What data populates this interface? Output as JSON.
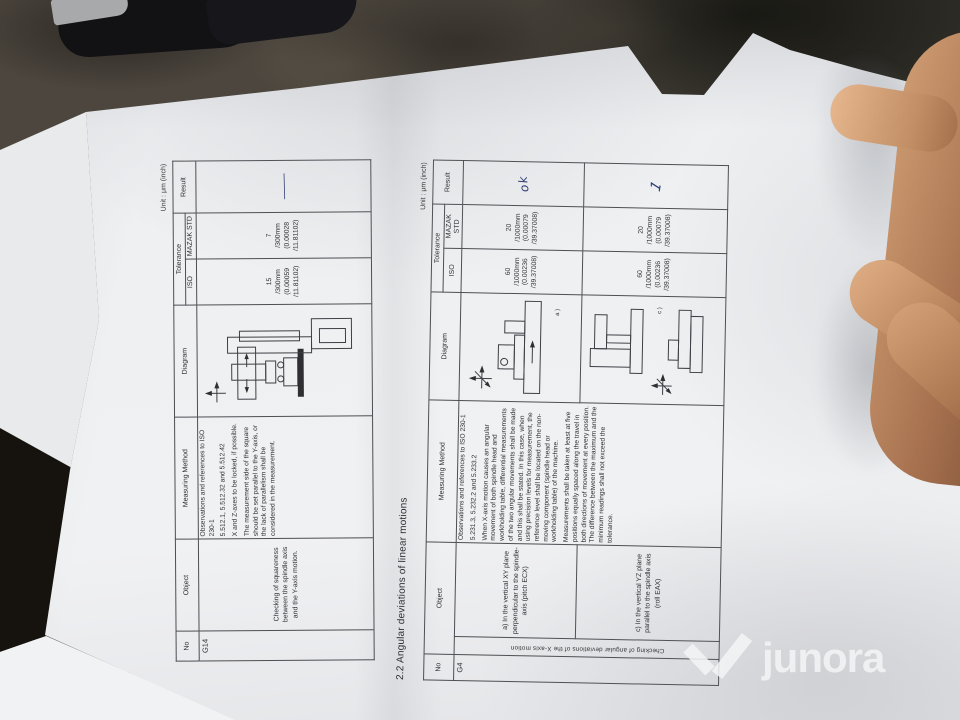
{
  "photo": {
    "watermark_brand": "junora"
  },
  "doc": {
    "section_title": "2.2 Angular deviations of linear motions",
    "unit_label": "Unit : μm (inch)",
    "headers": {
      "no": "No",
      "object": "Object",
      "method": "Measuring Method",
      "diagram": "Diagram",
      "tolerance": "Tolerance",
      "iso": "ISO",
      "mazak": "MAZAK STD",
      "result": "Result"
    },
    "squareness": {
      "no": "G14",
      "object": "Checking of squareness between the spindle axis and the Y-axis motion.",
      "method": {
        "p1": "Observations and references to ISO 230-1",
        "p2": "5.512.1, 5.512.32 and 5.512.42",
        "p3": "X and Z-axes to be locked, if possible.",
        "p4": "The measurement side of the square should be set parallel to the Y-axis, or the lack of parallelism shall be considered in the measurement."
      },
      "tol_iso": [
        "15",
        "/300mm",
        "(0.00059",
        "/11.81102)"
      ],
      "tol_mazak": [
        "7",
        "/300mm",
        "(0.00028",
        "/11.81102)"
      ],
      "result": "—"
    },
    "angular": {
      "no": "G4",
      "group_object": "Checking of angular deviations of the X-axis motion",
      "method": {
        "p1": "Observations and references to ISO 230-1",
        "p2": "5.231.3, 5.232.2 and 5.233.2",
        "p3": "When X-axis motion causes an angular movement of both spindle head and workholding table, differential measurements of the two angular movements shall be made and this shall be stated. In this case, when using precision levels for measurement, the reference level shall be located on the non-moving component (spindle head or workholding table) of the machine.",
        "p4": "Measurements shall be taken at least at five positions equally spaced along the travel in both directions of movement at every position. The difference between the maximum and the minimum readings shall not exceed the tolerance."
      },
      "rows": [
        {
          "object": "a) In the vertical XY plane perpendicular to the spindle-axis (pitch ECX)",
          "diagram_label": "a )",
          "tol_iso": [
            "60",
            "/1000mm",
            "(0.00236",
            "/39.37008)"
          ],
          "tol_mazak": [
            "20",
            "/1000mm",
            "(0.00079",
            "/39.37008)"
          ],
          "result": "ok"
        },
        {
          "object": "c) In the vertical YZ plane parallel to the spindle axis (roll EAX)",
          "diagram_label": "c )",
          "tol_iso": [
            "60",
            "/1000mm",
            "(0.00236",
            "/39.37008)"
          ],
          "tol_mazak": [
            "20",
            "/1000mm",
            "(0.00079",
            "/39.37008)"
          ],
          "result": "1"
        }
      ]
    }
  }
}
